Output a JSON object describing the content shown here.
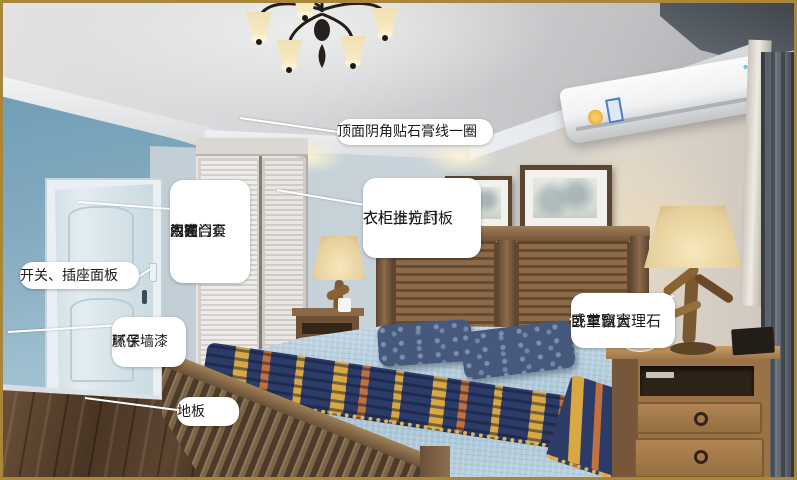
{
  "image": {
    "width": 797,
    "height": 480,
    "subject": "bedroom renovation annotated photo"
  },
  "annotations": {
    "ceiling_line": {
      "label": "顶面阴角贴石膏线一圈"
    },
    "door": {
      "lines": [
        "门碰",
        "门锁",
        "生态门",
        "木门合页",
        "双面门套"
      ]
    },
    "switch_panel": {
      "label": "开关、插座面板"
    },
    "wall_paint": {
      "lines": [
        "腻子",
        "环保墙漆"
      ]
    },
    "floor": {
      "label": "地板"
    },
    "wardrobe": {
      "lines": [
        "衣柜",
        "衣柜推拉门",
        "衣柜上方封板"
      ]
    },
    "bay_window": {
      "lines": [
        "卧室飘窗",
        "或单窗大理石"
      ]
    }
  },
  "scene": {
    "objects": [
      "chandelier",
      "air-conditioner",
      "entry-door",
      "light-switch",
      "wardrobe-sliding-doors",
      "wall-art-left",
      "wall-art-right",
      "headboard",
      "pillows",
      "bedspread",
      "throw-blanket",
      "footboard-bench",
      "wood-floor",
      "nightstand-left",
      "nightstand-right",
      "table-lamp-left",
      "table-lamp-right",
      "curtain",
      "radio"
    ],
    "palette": {
      "frame_gold": "#a8873b",
      "wall_blue": "#7da6bb",
      "wall_back": "#c6d1d8",
      "wall_warm": "#d8d1c8",
      "ceiling_gray": "#cfd0d3",
      "wood_dark": "#4e3a28",
      "wood_mid": "#8a6a48",
      "wood_light": "#b98c58",
      "bedding_blue": "#b6cede",
      "throw_navy": "#2c3b68",
      "throw_gold": "#d9a843",
      "lamp_shade": "#e8d6a8",
      "curtain_gray": "#5b626b",
      "label_bg": "#ffffff",
      "label_text": "#1c1c1c",
      "leader_line": "#ffffff"
    }
  }
}
